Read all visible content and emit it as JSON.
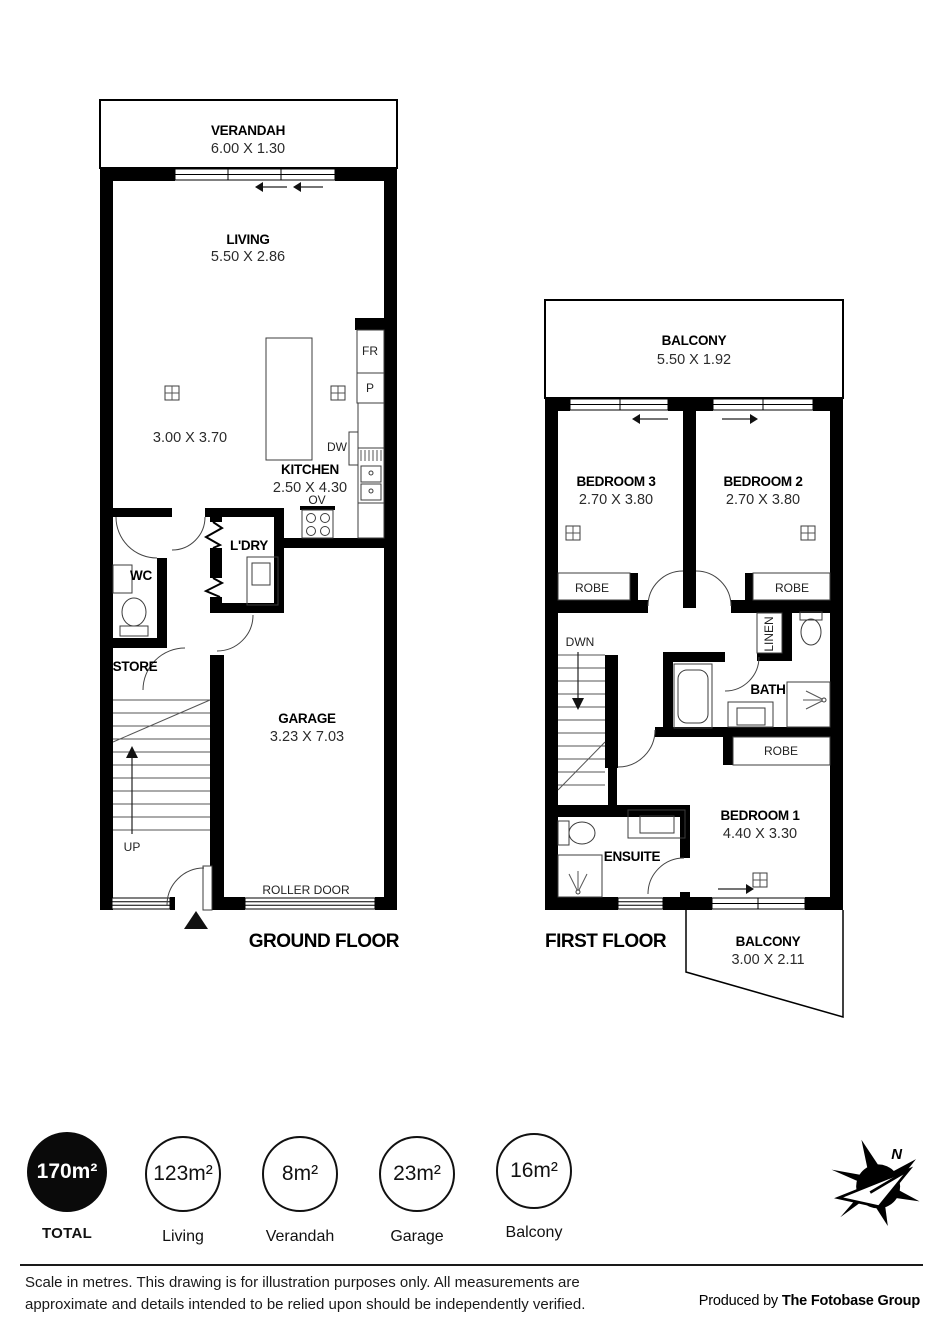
{
  "ground_floor": {
    "verandah": {
      "name": "VERANDAH",
      "dim": "6.00 X 1.30"
    },
    "living": {
      "name": "LIVING",
      "dim": "5.50 X 2.86"
    },
    "meals_dim": "3.00 X 3.70",
    "kitchen": {
      "name": "KITCHEN",
      "dim": "2.50 X 4.30"
    },
    "appliances": {
      "fridge": "FR",
      "pantry": "P",
      "dishwasher": "DW",
      "oven": "OV"
    },
    "wc": "WC",
    "laundry": "L'DRY",
    "store": "STORE",
    "garage": {
      "name": "GARAGE",
      "dim": "3.23 X 7.03"
    },
    "up": "UP",
    "roller_door": "ROLLER DOOR",
    "label": "GROUND FLOOR"
  },
  "first_floor": {
    "balcony_top": {
      "name": "BALCONY",
      "dim": "5.50 X 1.92"
    },
    "bedroom3": {
      "name": "BEDROOM 3",
      "dim": "2.70 X 3.80"
    },
    "bedroom2": {
      "name": "BEDROOM 2",
      "dim": "2.70 X 3.80"
    },
    "bedroom1": {
      "name": "BEDROOM 1",
      "dim": "4.40 X 3.30"
    },
    "robe": "ROBE",
    "linen": "LINEN",
    "dwn": "DWN",
    "bath": "BATH",
    "ensuite": "ENSUITE",
    "balcony_bottom": {
      "name": "BALCONY",
      "dim": "3.00 X 2.11"
    },
    "label": "FIRST FLOOR"
  },
  "badges": {
    "total": {
      "value": "170m²",
      "label": "TOTAL"
    },
    "living": {
      "value": "123m²",
      "label": "Living"
    },
    "verandah": {
      "value": "8m²",
      "label": "Verandah"
    },
    "garage": {
      "value": "23m²",
      "label": "Garage"
    },
    "balcony": {
      "value": "16m²",
      "label": "Balcony"
    }
  },
  "footer": {
    "disclaimer": "Scale in metres. This drawing is for illustration purposes only. All measurements are approximate and details intended to be relied upon should be independently verified.",
    "credit_prefix": "Produced by ",
    "credit_name": "The Fotobase Group"
  },
  "logo": {
    "north": "N"
  },
  "colors": {
    "ink": "#111111",
    "wall": "#000000"
  }
}
